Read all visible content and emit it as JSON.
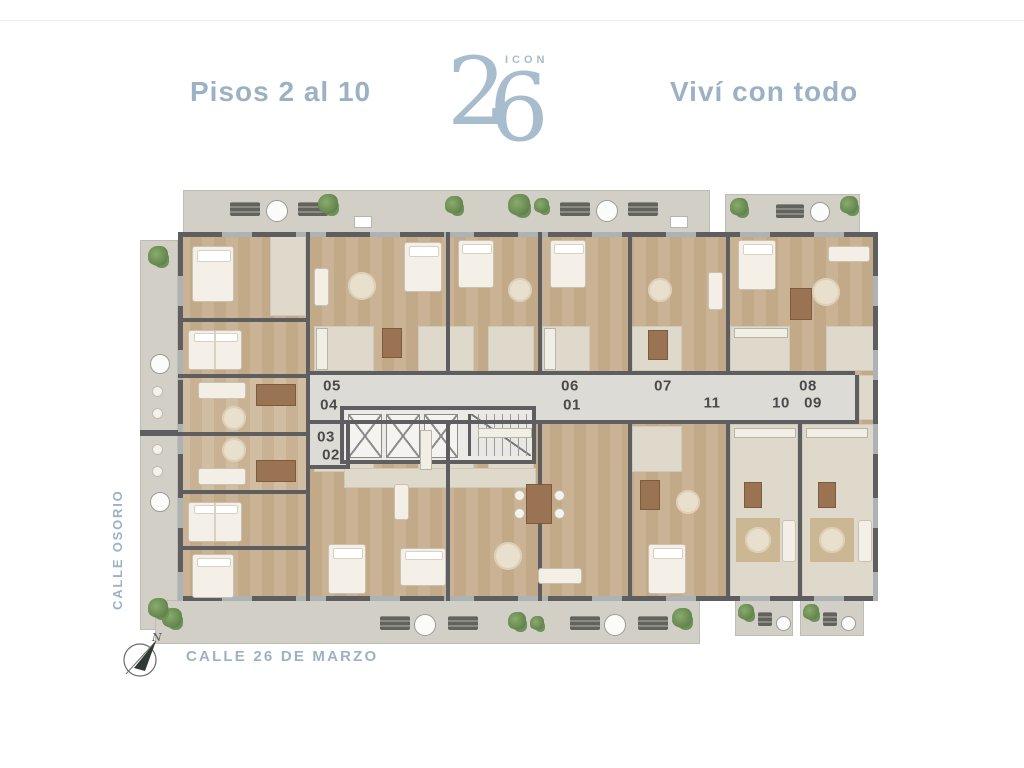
{
  "header": {
    "floors_label": "Pisos 2 al 10",
    "tagline": "Viví con todo",
    "logo_number_left": "2",
    "logo_number_right": "6",
    "logo_name": "ICON"
  },
  "streets": {
    "left_street": "CALLE OSORIO",
    "bottom_street": "CALLE 26 DE MARZO"
  },
  "compass": {
    "north_label": "N"
  },
  "floorplan": {
    "units": [
      {
        "label": "05",
        "x": 192,
        "y": 200
      },
      {
        "label": "04",
        "x": 189,
        "y": 219
      },
      {
        "label": "03",
        "x": 186,
        "y": 251
      },
      {
        "label": "02",
        "x": 191,
        "y": 269
      },
      {
        "label": "06",
        "x": 430,
        "y": 200
      },
      {
        "label": "01",
        "x": 432,
        "y": 219
      },
      {
        "label": "07",
        "x": 523,
        "y": 200
      },
      {
        "label": "08",
        "x": 668,
        "y": 200
      },
      {
        "label": "11",
        "x": 572,
        "y": 217
      },
      {
        "label": "10",
        "x": 641,
        "y": 217
      },
      {
        "label": "09",
        "x": 673,
        "y": 217
      }
    ],
    "colors": {
      "accent_text": "#9cb2c4",
      "logo": "#a7bccd",
      "unit_number": "#4a4a4c",
      "wall": "#5e5e61",
      "wood_floor": "#c8b092",
      "service_floor": "#ded9cb",
      "corridor": "#dcdbd6",
      "balcony": "#d2cfc7",
      "plant_green": "#6a8f54"
    }
  }
}
